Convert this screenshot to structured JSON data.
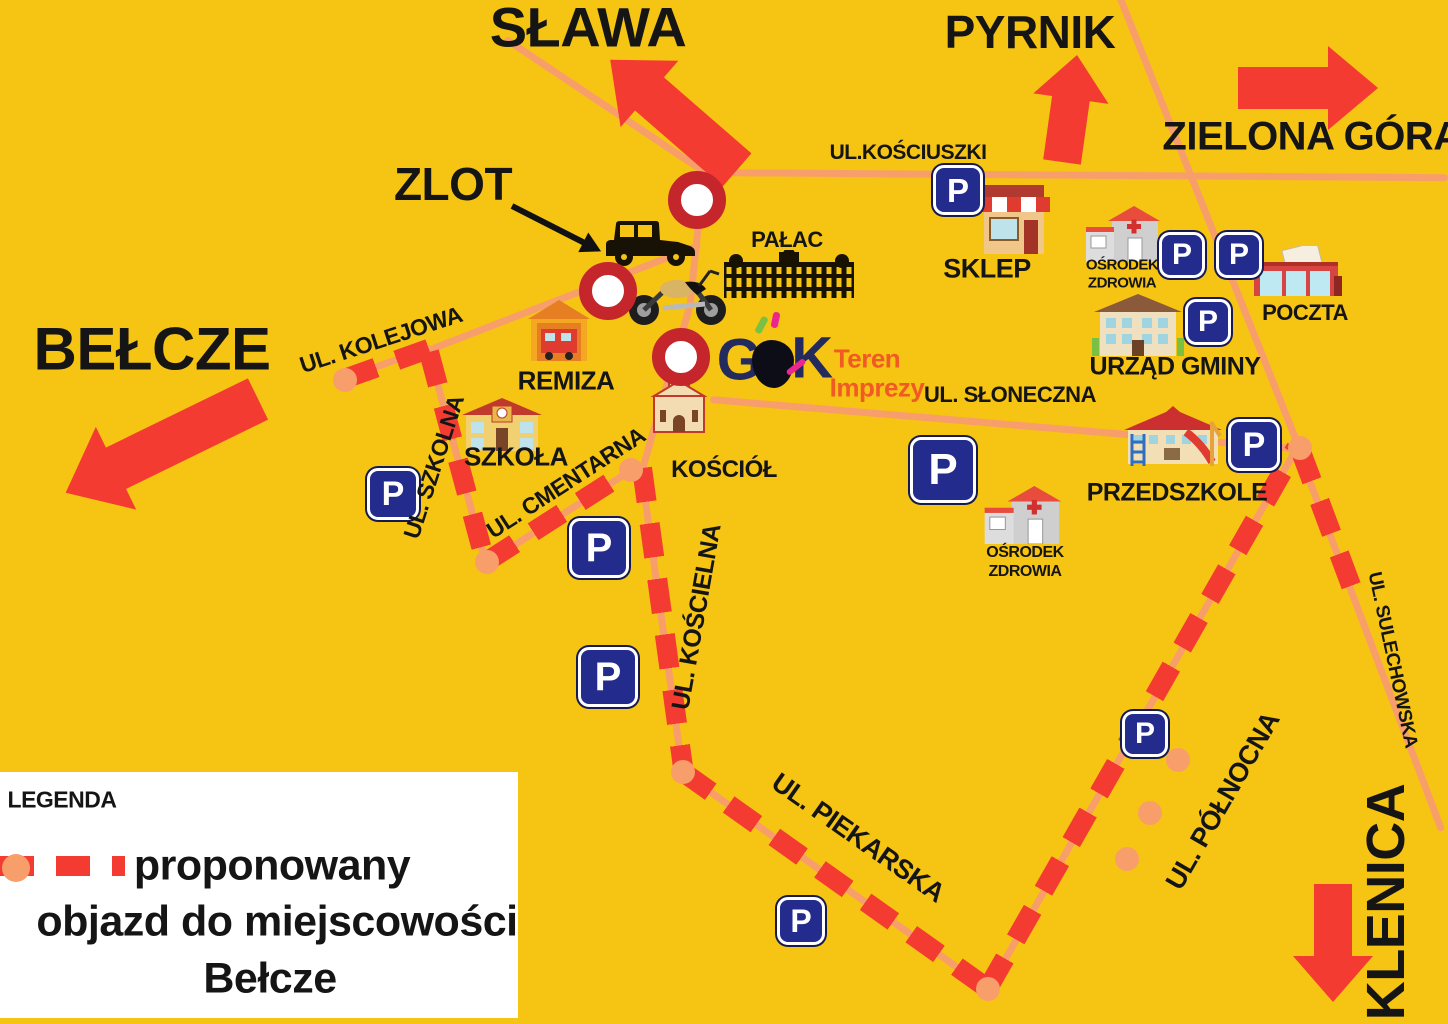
{
  "colors": {
    "background": "#F6C413",
    "red": "#F43B31",
    "road": "#F89E6B",
    "navy": "#232C8C",
    "crimson": "#C4262C",
    "text": "#151515",
    "gok_navy": "#232A5E",
    "gok_orange": "#F15A25",
    "legend_bg": "#FFFFFF"
  },
  "destinations": {
    "slawa": "SŁAWA",
    "pyrnik": "PYRNIK",
    "zielona_gora": "ZIELONA GÓRA",
    "belcze": "BEŁCZE",
    "klenica": "KLENICA"
  },
  "event": {
    "zlot": "ZLOT"
  },
  "streets": {
    "kosciuszki": "UL.KOŚCIUSZKI",
    "kolejowa": "UL. KOLEJOWA",
    "szkolna": "UL. SZKOLNA",
    "cmentarna": "UL. CMENTARNA",
    "koscielna": "UL. KOŚCIELNA",
    "sloneczna": "UL. SŁONECZNA",
    "piekarska": "UL. PIEKARSKA",
    "polnocna": "UL. PÓŁNOCNA",
    "sulechowska": "UL. SULECHOWSKA"
  },
  "places": {
    "palac": "PAŁAC",
    "sklep": "SKLEP",
    "urzad_gminy": "URZĄD GMINY",
    "poczta": "POCZTA",
    "remiza": "REMIZA",
    "szkola": "SZKOŁA",
    "kosciol": "KOŚCIÓŁ",
    "przedszkole": "PRZEDSZKOLE",
    "osrodek_line1": "OŚRODEK",
    "osrodek_line2": "ZDROWIA"
  },
  "gok": {
    "g": "G",
    "k": "K",
    "teren": "Teren",
    "imprezy": "Imprezy"
  },
  "parking": {
    "letter": "P"
  },
  "legend": {
    "title": "LEGENDA",
    "line1": "proponowany",
    "line2": "objazd do miejscowości",
    "line3": "Bełcze"
  }
}
